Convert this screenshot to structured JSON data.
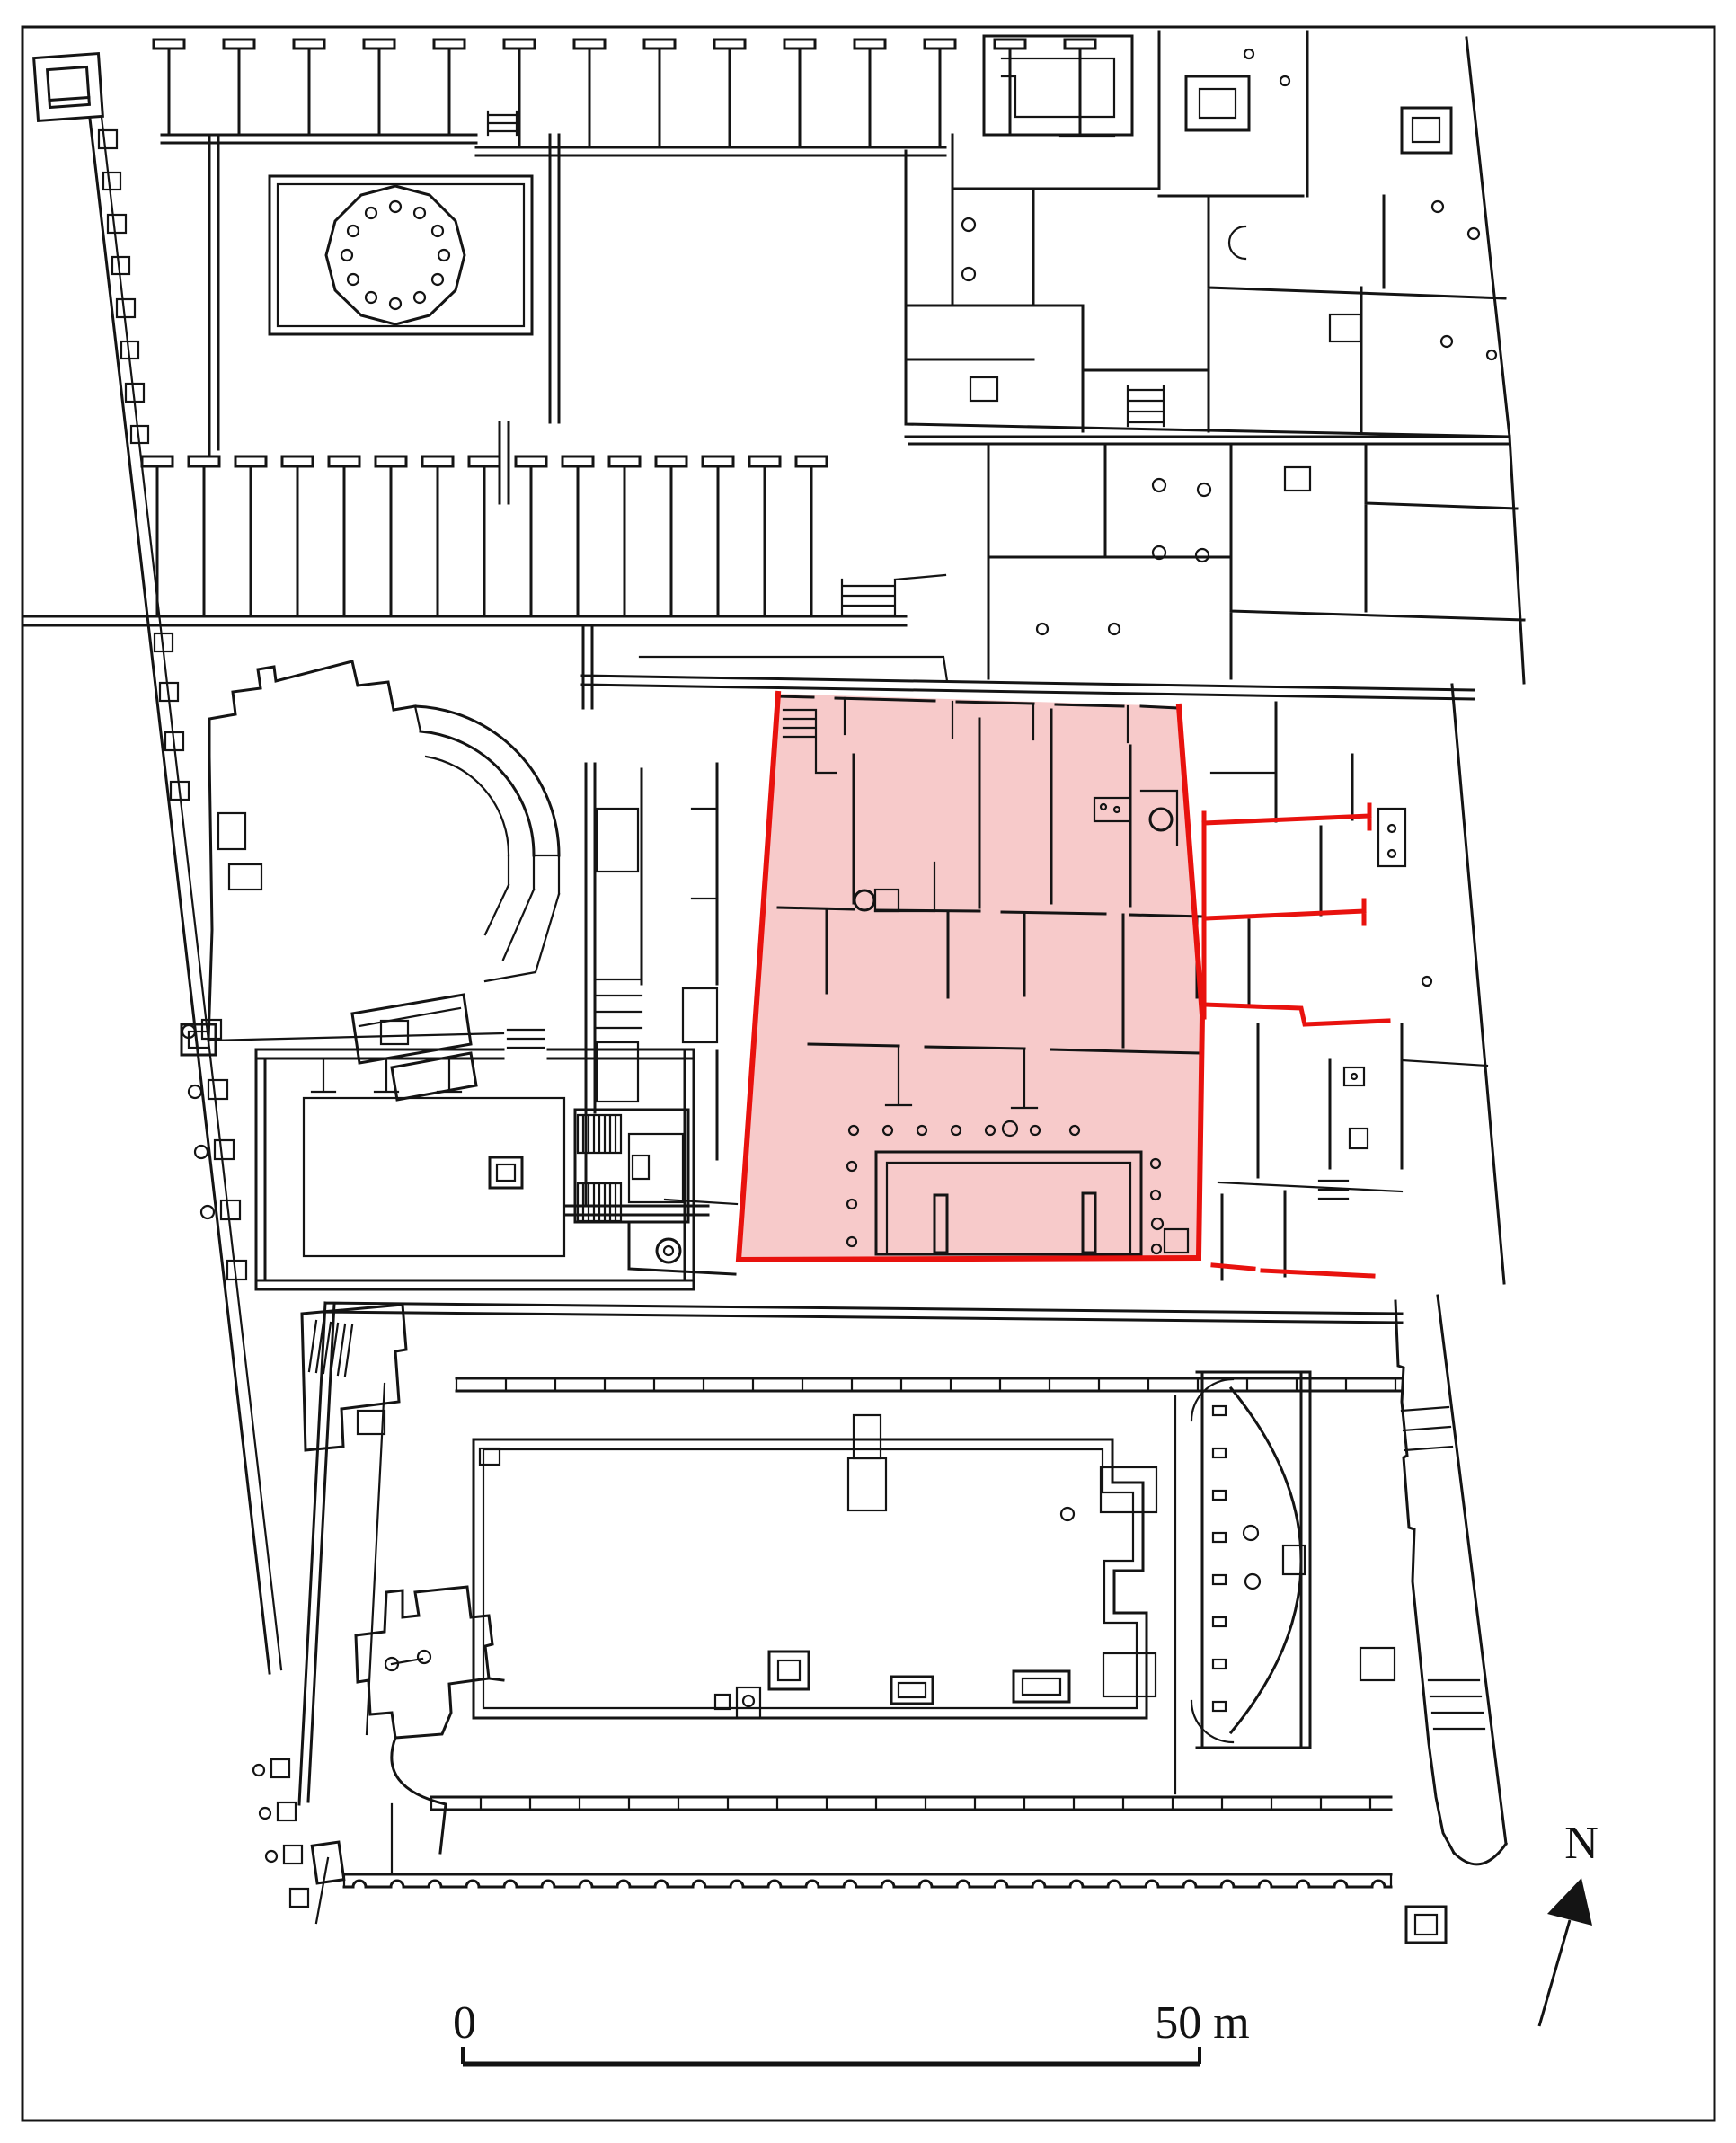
{
  "map": {
    "type": "archaeological-site-plan",
    "north_arrow": {
      "label": "N"
    },
    "scale_bar": {
      "start_label": "0",
      "end_label": "50 m"
    },
    "colors": {
      "highlight_fill": "#f7caca",
      "highlight_outline": "#e8120e",
      "wall": "#141414",
      "background": "#ffffff"
    }
  }
}
